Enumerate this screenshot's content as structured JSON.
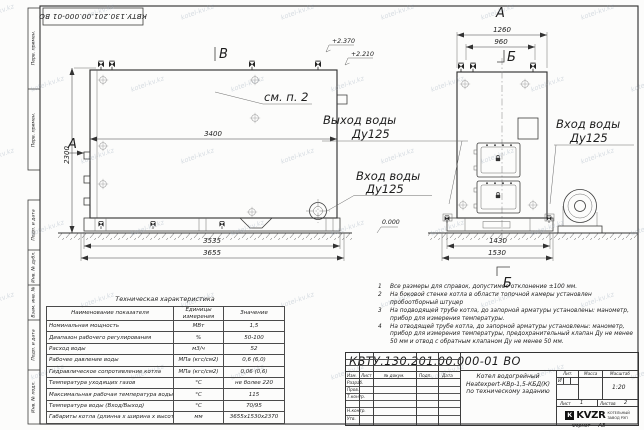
{
  "watermark": "kotel-kv.kz",
  "frame": {
    "top_stamp": "КВТУ.130.201.00.000-01 ВО",
    "strip_top": [
      "Перв. примен.",
      "Перв. примен."
    ],
    "strip_bottom": [
      "Подп. и дата",
      "Инв. № дубл.",
      "Взам. инв. №",
      "Подп. и дата",
      "Инв. № подл."
    ],
    "format_label": "Формат",
    "format_value": "А3"
  },
  "drawing": {
    "view_top_label": "В",
    "front_view_label": "А",
    "side_arrow_label": "А",
    "section_top_label": "Б",
    "section_bottom_label": "Б",
    "callout": "см. п. 2",
    "elev1": "+2.370",
    "elev2": "+2.210",
    "elev_zero": "0.000",
    "outlet_line1": "Выход воды",
    "outlet_line2": "Ду125",
    "inlet_front_line1": "Вход воды",
    "inlet_front_line2": "Ду125",
    "inlet_side_line1": "Вход воды",
    "inlet_side_line2": "Ду125",
    "dim_3400": "3400",
    "dim_2300": "2300",
    "dim_3535": "3535",
    "dim_3655": "3655",
    "dim_1260": "1260",
    "dim_960": "960",
    "dim_1430": "1430",
    "dim_1530": "1530"
  },
  "tech": {
    "title": "Техническая характеристика",
    "headers": [
      "Наименование показателя",
      "Единицы измерения",
      "Значение"
    ],
    "rows": [
      [
        "Номинальная мощность",
        "МВт",
        "1,5"
      ],
      [
        "Диапазон рабочего регулирования",
        "%",
        "50-100"
      ],
      [
        "Расход воды",
        "м3/ч",
        "52"
      ],
      [
        "Рабочее давление воды",
        "МПа (кгс/см2)",
        "0,6 (6,0)"
      ],
      [
        "Гидравлическое сопротивление котла",
        "МПа (кгс/см2)",
        "0,06 (0,6)"
      ],
      [
        "Температура уходящих газов",
        "°С",
        "не более 220"
      ],
      [
        "Максимальная рабочая температура воды",
        "°С",
        "115"
      ],
      [
        "Температура воды (Вход/Выход)",
        "°С",
        "70/95"
      ],
      [
        "Габариты котла (длинна х ширина х высота)",
        "мм",
        "3655х1530х2370"
      ]
    ]
  },
  "notes": {
    "items": [
      {
        "n": "1",
        "t": "Все размеры для справок, допустимое отклонение ±100 мм."
      },
      {
        "n": "2",
        "t": "На боковой стенке котла в области топочной камеры установлен пробоотборный штуцер"
      },
      {
        "n": "3",
        "t": "На подводящей трубе котла, до запорной арматуры установлены: манометр, прибор для измерения температуры."
      },
      {
        "n": "4",
        "t": "На отводящей трубе котла, до запорной арматуры установлены: манометр, прибор для измерения температуры, предохранительный клапан Ду не менее 50 мм и отвод с обратным клапаном Ду не менее 50 мм."
      }
    ]
  },
  "title_block": {
    "doc_number": "КВТУ.130.201.00.000-01 ВО",
    "product_line1": "Котел водогрейный",
    "product_line2": "Heatexpert-КВр-1,5-КБД(К)",
    "product_line3": "по техническому заданию",
    "col_izm": "Изм.",
    "col_list": "Лист",
    "col_doc": "№ докум.",
    "col_podp": "Подп.",
    "col_data": "Дата",
    "roles": [
      "Разраб.",
      "Пров.",
      "Т.контр.",
      "Н.контр.",
      "Утв."
    ],
    "lit_label": "Лит.",
    "lit_value": "И",
    "mass_label": "Масса",
    "scale_label": "Масштаб",
    "scale_value": "1:20",
    "sheet_label": "Лист",
    "sheet_value": "1",
    "sheets_label": "Листов",
    "sheets_value": "2",
    "logo_mark": "К",
    "logo_text": "KVZR",
    "logo_sub1": "КОТЕЛЬНЫЙ",
    "logo_sub2": "ЗАВОД РЭП"
  }
}
